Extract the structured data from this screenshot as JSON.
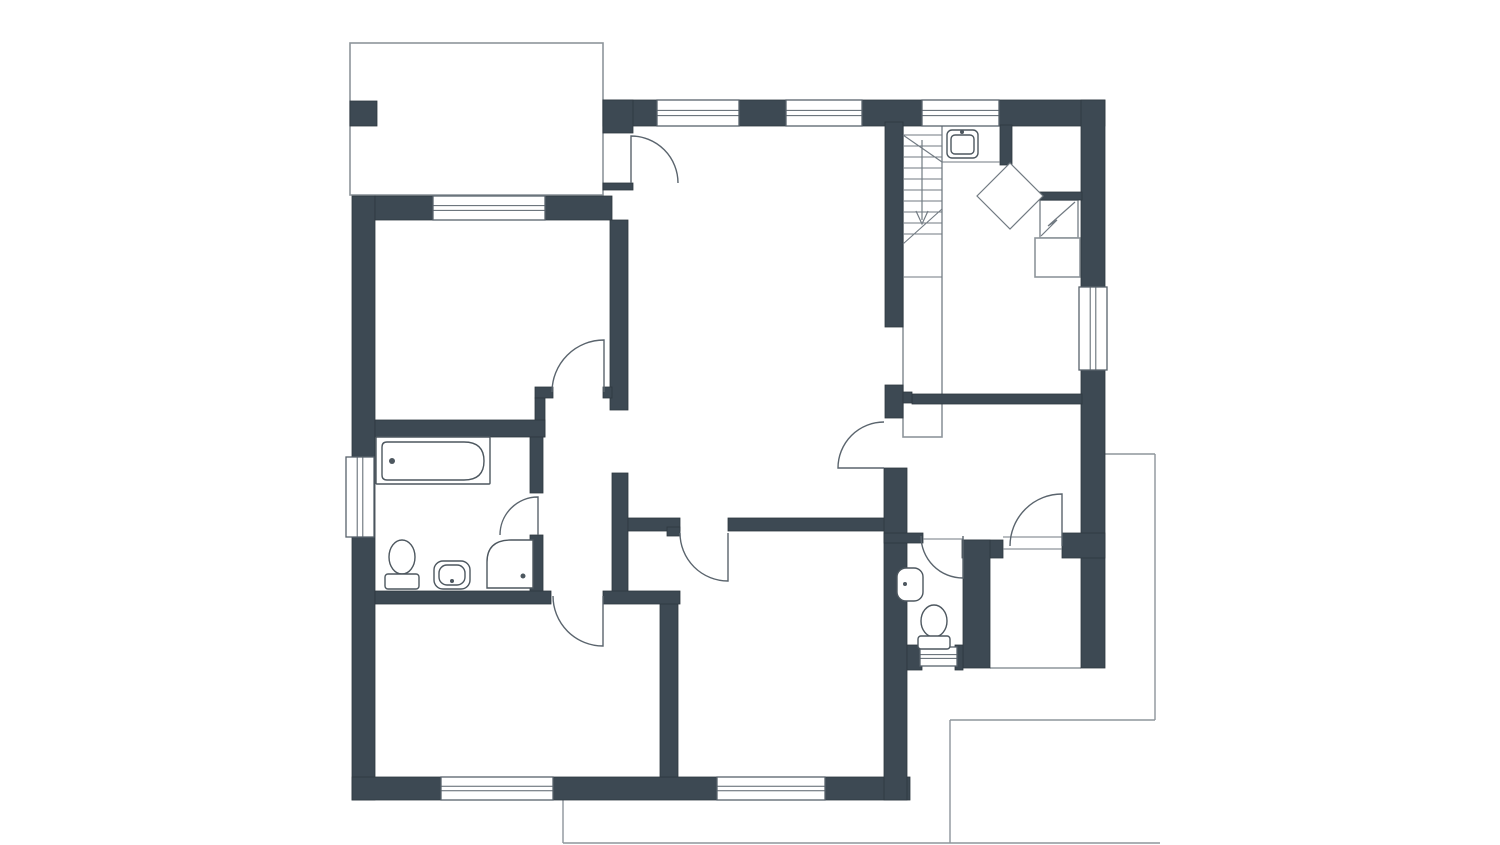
{
  "meta": {
    "type": "floor-plan",
    "text_labels": []
  },
  "colors": {
    "background": "#ffffff",
    "wall": "#3d4953",
    "wall_edge": "#2e3840",
    "thin": "#717a82",
    "porch": "#8d959b",
    "frame": "#58626b",
    "door": "#5a646d",
    "fixture": "#4d575f"
  },
  "plan": {
    "canvas": {
      "width": 1500,
      "height": 845
    },
    "outlines": [
      {
        "name": "porch-outline",
        "x": 350,
        "y": 43,
        "w": 253,
        "h": 152
      },
      {
        "name": "stair-enclosure",
        "x": 903,
        "y": 125,
        "w": 39,
        "h": 312
      },
      {
        "name": "chimney-box",
        "x": 1040,
        "y": 200,
        "w": 38,
        "h": 38
      },
      {
        "name": "chimney-base",
        "x": 1035,
        "y": 238,
        "w": 45,
        "h": 39
      }
    ],
    "terrace_lines": [
      {
        "name": "terrace-line",
        "x1": 1105,
        "y1": 454,
        "x2": 1155,
        "y2": 454
      },
      {
        "name": "terrace-line",
        "x1": 1155,
        "y1": 454,
        "x2": 1155,
        "y2": 720
      },
      {
        "name": "terrace-line",
        "x1": 950,
        "y1": 720,
        "x2": 1155,
        "y2": 720
      },
      {
        "name": "terrace-line",
        "x1": 950,
        "y1": 720,
        "x2": 950,
        "y2": 843
      },
      {
        "name": "terrace-line",
        "x1": 563,
        "y1": 800,
        "x2": 563,
        "y2": 843
      },
      {
        "name": "terrace-line",
        "x1": 563,
        "y1": 843,
        "x2": 1160,
        "y2": 843
      },
      {
        "name": "storage-open-edge",
        "x1": 990,
        "y1": 668,
        "x2": 1081,
        "y2": 668
      }
    ],
    "walls": [
      {
        "name": "top-wall-a",
        "x": 603,
        "y": 100,
        "w": 54,
        "h": 26
      },
      {
        "name": "top-wall-b",
        "x": 739,
        "y": 100,
        "w": 47,
        "h": 26
      },
      {
        "name": "top-wall-c",
        "x": 862,
        "y": 100,
        "w": 60,
        "h": 26
      },
      {
        "name": "top-wall-d",
        "x": 999,
        "y": 100,
        "w": 106,
        "h": 26
      },
      {
        "name": "right-wall-upper",
        "x": 1081,
        "y": 100,
        "w": 24,
        "h": 187
      },
      {
        "name": "right-wall-lower",
        "x": 1081,
        "y": 370,
        "w": 24,
        "h": 298
      },
      {
        "name": "left-wall",
        "x": 352,
        "y": 196,
        "w": 23,
        "h": 604
      },
      {
        "name": "bottom-wall-a",
        "x": 352,
        "y": 777,
        "w": 89,
        "h": 23
      },
      {
        "name": "bottom-wall-b",
        "x": 553,
        "y": 777,
        "w": 164,
        "h": 23
      },
      {
        "name": "bottom-wall-c",
        "x": 825,
        "y": 777,
        "w": 85,
        "h": 23
      },
      {
        "name": "bedroom-top-wall-a",
        "x": 375,
        "y": 196,
        "w": 58,
        "h": 24
      },
      {
        "name": "bedroom-top-wall-b",
        "x": 545,
        "y": 196,
        "w": 67,
        "h": 24
      },
      {
        "name": "bedroom-right-wall",
        "x": 610,
        "y": 220,
        "w": 18,
        "h": 190
      },
      {
        "name": "bedroom-door-stub",
        "x": 535,
        "y": 387,
        "w": 18,
        "h": 11
      },
      {
        "name": "bedroom-door-jamb",
        "x": 603,
        "y": 387,
        "w": 9,
        "h": 11
      },
      {
        "name": "bath-connector-wall",
        "x": 535,
        "y": 398,
        "w": 10,
        "h": 39
      },
      {
        "name": "bathroom-top-wall",
        "x": 375,
        "y": 420,
        "w": 170,
        "h": 17
      },
      {
        "name": "bathroom-right-wall-a",
        "x": 530,
        "y": 437,
        "w": 13,
        "h": 56
      },
      {
        "name": "bathroom-right-wall-b",
        "x": 530,
        "y": 535,
        "w": 13,
        "h": 62
      },
      {
        "name": "vestibule-right-wall",
        "x": 612,
        "y": 473,
        "w": 16,
        "h": 124
      },
      {
        "name": "hall-wall-a",
        "x": 628,
        "y": 518,
        "w": 52,
        "h": 13
      },
      {
        "name": "hall-wall-b",
        "x": 728,
        "y": 518,
        "w": 157,
        "h": 13
      },
      {
        "name": "hall-door-jamb",
        "x": 667,
        "y": 527,
        "w": 13,
        "h": 9
      },
      {
        "name": "rooms-divider-wall",
        "x": 660,
        "y": 593,
        "w": 18,
        "h": 184
      },
      {
        "name": "lower-wall-a",
        "x": 375,
        "y": 591,
        "w": 176,
        "h": 13
      },
      {
        "name": "lower-wall-b",
        "x": 603,
        "y": 591,
        "w": 77,
        "h": 13
      },
      {
        "name": "entry-wall",
        "x": 603,
        "y": 100,
        "w": 30,
        "h": 33
      },
      {
        "name": "entry-jamb",
        "x": 603,
        "y": 183,
        "w": 30,
        "h": 7
      },
      {
        "name": "stair-wall",
        "x": 885,
        "y": 122,
        "w": 18,
        "h": 205
      },
      {
        "name": "stair-wall-stub",
        "x": 885,
        "y": 385,
        "w": 18,
        "h": 33
      },
      {
        "name": "right-spine-wall",
        "x": 884,
        "y": 468,
        "w": 23,
        "h": 332
      },
      {
        "name": "kitchen-top-wall",
        "x": 912,
        "y": 394,
        "w": 170,
        "h": 10
      },
      {
        "name": "kitchen-top-jamb",
        "x": 903,
        "y": 392,
        "w": 9,
        "h": 11
      },
      {
        "name": "topright-partition",
        "x": 1000,
        "y": 125,
        "w": 12,
        "h": 40
      },
      {
        "name": "topright-wall",
        "x": 1037,
        "y": 192,
        "w": 45,
        "h": 8
      },
      {
        "name": "kitchen-bottom-wall-a",
        "x": 962,
        "y": 540,
        "w": 41,
        "h": 18
      },
      {
        "name": "kitchen-bottom-wall-b",
        "x": 1062,
        "y": 533,
        "w": 43,
        "h": 25
      },
      {
        "name": "wc-top-wall",
        "x": 884,
        "y": 533,
        "w": 39,
        "h": 10
      },
      {
        "name": "wc-right-wall",
        "x": 963,
        "y": 540,
        "w": 27,
        "h": 128
      },
      {
        "name": "wc-bottom-wall-a",
        "x": 907,
        "y": 645,
        "w": 15,
        "h": 25
      },
      {
        "name": "wc-bottom-wall-b",
        "x": 955,
        "y": 645,
        "w": 8,
        "h": 25
      },
      {
        "name": "porch-pillar",
        "x": 350,
        "y": 101,
        "w": 27,
        "h": 25
      }
    ],
    "windows": [
      {
        "name": "window-top-1",
        "x": 657,
        "y": 100,
        "w": 82,
        "h": 26,
        "orient": "h"
      },
      {
        "name": "window-top-2",
        "x": 786,
        "y": 100,
        "w": 76,
        "h": 26,
        "orient": "h"
      },
      {
        "name": "window-top-3",
        "x": 922,
        "y": 100,
        "w": 77,
        "h": 26,
        "orient": "h"
      },
      {
        "name": "window-bedroom",
        "x": 433,
        "y": 196,
        "w": 112,
        "h": 24,
        "orient": "h"
      },
      {
        "name": "window-bathroom",
        "x": 346,
        "y": 457,
        "w": 28,
        "h": 80,
        "orient": "v"
      },
      {
        "name": "window-right",
        "x": 1079,
        "y": 287,
        "w": 28,
        "h": 83,
        "orient": "v"
      },
      {
        "name": "window-bottom-1",
        "x": 441,
        "y": 777,
        "w": 112,
        "h": 23,
        "orient": "h"
      },
      {
        "name": "window-bottom-2",
        "x": 717,
        "y": 777,
        "w": 108,
        "h": 23,
        "orient": "h"
      },
      {
        "name": "window-wc",
        "x": 920,
        "y": 647,
        "w": 37,
        "h": 19,
        "orient": "h"
      }
    ],
    "thin_lines": [
      {
        "name": "stair-tread",
        "x1": 903,
        "y1": 135,
        "x2": 942,
        "y2": 135
      },
      {
        "name": "stair-tread",
        "x1": 903,
        "y1": 146,
        "x2": 942,
        "y2": 146
      },
      {
        "name": "stair-tread",
        "x1": 903,
        "y1": 157,
        "x2": 942,
        "y2": 157
      },
      {
        "name": "stair-tread",
        "x1": 903,
        "y1": 168,
        "x2": 942,
        "y2": 168
      },
      {
        "name": "stair-tread",
        "x1": 903,
        "y1": 179,
        "x2": 942,
        "y2": 179
      },
      {
        "name": "stair-tread",
        "x1": 903,
        "y1": 190,
        "x2": 942,
        "y2": 190
      },
      {
        "name": "stair-tread",
        "x1": 903,
        "y1": 201,
        "x2": 942,
        "y2": 201
      },
      {
        "name": "stair-tread",
        "x1": 903,
        "y1": 212,
        "x2": 942,
        "y2": 212
      },
      {
        "name": "stair-tread",
        "x1": 903,
        "y1": 223,
        "x2": 942,
        "y2": 223
      },
      {
        "name": "stair-tread",
        "x1": 903,
        "y1": 234,
        "x2": 942,
        "y2": 234
      },
      {
        "name": "stair-landing-edge",
        "x1": 903,
        "y1": 277,
        "x2": 942,
        "y2": 277
      },
      {
        "name": "stair-break-line",
        "x1": 903,
        "y1": 135,
        "x2": 942,
        "y2": 162
      },
      {
        "name": "stair-break-line",
        "x1": 903,
        "y1": 244,
        "x2": 942,
        "y2": 209
      },
      {
        "name": "counter-edge",
        "x1": 942,
        "y1": 162,
        "x2": 1000,
        "y2": 162
      },
      {
        "name": "door-threshold",
        "x1": 1003,
        "y1": 537,
        "x2": 1062,
        "y2": 537
      },
      {
        "name": "door-threshold",
        "x1": 1003,
        "y1": 549,
        "x2": 1062,
        "y2": 549
      },
      {
        "name": "door-threshold",
        "x1": 923,
        "y1": 539,
        "x2": 963,
        "y2": 539
      },
      {
        "name": "shower-grid",
        "x1": 1018.2,
        "y1": 171.3,
        "x2": 985.3,
        "y2": 204.2
      },
      {
        "name": "shower-grid",
        "x1": 1026.5,
        "y1": 179.5,
        "x2": 993.5,
        "y2": 212.5
      },
      {
        "name": "shower-grid",
        "x1": 1034.7,
        "y1": 187.8,
        "x2": 1001.8,
        "y2": 220.7
      },
      {
        "name": "shower-grid",
        "x1": 1001.8,
        "y1": 171.3,
        "x2": 1034.7,
        "y2": 204.2
      },
      {
        "name": "shower-grid",
        "x1": 993.5,
        "y1": 179.5,
        "x2": 1026.5,
        "y2": 212.5
      },
      {
        "name": "shower-grid",
        "x1": 985.3,
        "y1": 187.8,
        "x2": 1018.2,
        "y2": 220.7
      }
    ],
    "doors": [
      {
        "name": "entry-door",
        "d": "M 631 183 L 631 136 A 47 47 0 0 1 678 183"
      },
      {
        "name": "bedroom-door",
        "d": "M 604 392 L 604 340 A 52 52 0 0 0 552 392"
      },
      {
        "name": "bathroom-door",
        "d": "M 538 535 L 538 497 A 38 38 0 0 0 500 535"
      },
      {
        "name": "room-bl-door",
        "d": "M 603 596 L 603 646 A 50 50 0 0 1 553 596"
      },
      {
        "name": "room-bm-door",
        "d": "M 728 533 L 728 581 A 48 48 0 0 1 680 533"
      },
      {
        "name": "kitchen-door",
        "d": "M 884 468 L 838 468 A 46 46 0 0 1 884 422"
      },
      {
        "name": "storage-door",
        "d": "M 1062 546 L 1062 494 A 52 52 0 0 0 1010 546"
      },
      {
        "name": "wc-door",
        "d": "M 963 536 L 963 578 A 42 42 0 0 1 921 536"
      }
    ],
    "symbols": [
      {
        "name": "shower-diamond",
        "d": "M 1010 163 L 1043 196 L 1010 229 L 977 196 Z",
        "fill": "#ffffff"
      },
      {
        "name": "chimney-zigzag",
        "d": "M 1075 202 L 1048 226 L 1057 220 L 1041 236",
        "fill": "none"
      },
      {
        "name": "stair-arrow-line",
        "d": "M 922 140 L 922 220",
        "fill": "none"
      },
      {
        "name": "stair-arrow-head",
        "d": "M 916 211 L 922 224 L 928 211",
        "fill": "none"
      }
    ],
    "fixtures": [
      {
        "name": "bathtub-outline",
        "type": "rect",
        "x": 376,
        "y": 437,
        "w": 114,
        "h": 47,
        "rx": 1
      },
      {
        "name": "bathtub-inner",
        "type": "path",
        "d": "M 387 442 L 464 442 Q 484 442 484 461 Q 484 480 464 480 L 387 480 Q 382 480 382 475 L 382 447 Q 382 442 387 442 Z"
      },
      {
        "name": "bathtub-faucet",
        "type": "circle",
        "cx": 392,
        "cy": 461,
        "r": 3
      },
      {
        "name": "bath-toilet-bowl",
        "type": "ellipse",
        "cx": 402,
        "cy": 557,
        "rx": 13,
        "ry": 17
      },
      {
        "name": "bath-toilet-tank",
        "type": "rect",
        "x": 385,
        "y": 574,
        "w": 34,
        "h": 15,
        "rx": 3
      },
      {
        "name": "bath-sink",
        "type": "rect",
        "x": 434,
        "y": 561,
        "w": 36,
        "h": 28,
        "rx": 9
      },
      {
        "name": "bath-sink-basin",
        "type": "rect",
        "x": 439,
        "y": 565,
        "w": 26,
        "h": 20,
        "rx": 8
      },
      {
        "name": "bath-sink-drain",
        "type": "circle",
        "cx": 452,
        "cy": 581,
        "r": 2
      },
      {
        "name": "bath-shower-tray",
        "type": "path",
        "d": "M 487 588 L 487 562 Q 487 540 511 540 L 533 540 L 533 588 Z"
      },
      {
        "name": "bath-shower-drain",
        "type": "circle",
        "cx": 523,
        "cy": 576,
        "r": 2.5
      },
      {
        "name": "wc-sink",
        "type": "rect",
        "x": 897,
        "y": 568,
        "w": 26,
        "h": 33,
        "rx": 9
      },
      {
        "name": "wc-sink-drain",
        "type": "circle",
        "cx": 905,
        "cy": 584,
        "r": 2
      },
      {
        "name": "wc-toilet-bowl",
        "type": "ellipse",
        "cx": 934,
        "cy": 621,
        "rx": 13,
        "ry": 16
      },
      {
        "name": "wc-toilet-tank",
        "type": "rect",
        "x": 918,
        "y": 636,
        "w": 32,
        "h": 13,
        "rx": 3
      },
      {
        "name": "stair-sink",
        "type": "rect",
        "x": 947,
        "y": 130,
        "w": 31,
        "h": 28,
        "rx": 5
      },
      {
        "name": "stair-sink-basin",
        "type": "rect",
        "x": 951,
        "y": 135,
        "w": 23,
        "h": 19,
        "rx": 4
      },
      {
        "name": "stair-sink-faucet",
        "type": "circle",
        "cx": 962,
        "cy": 132,
        "r": 2
      }
    ]
  }
}
